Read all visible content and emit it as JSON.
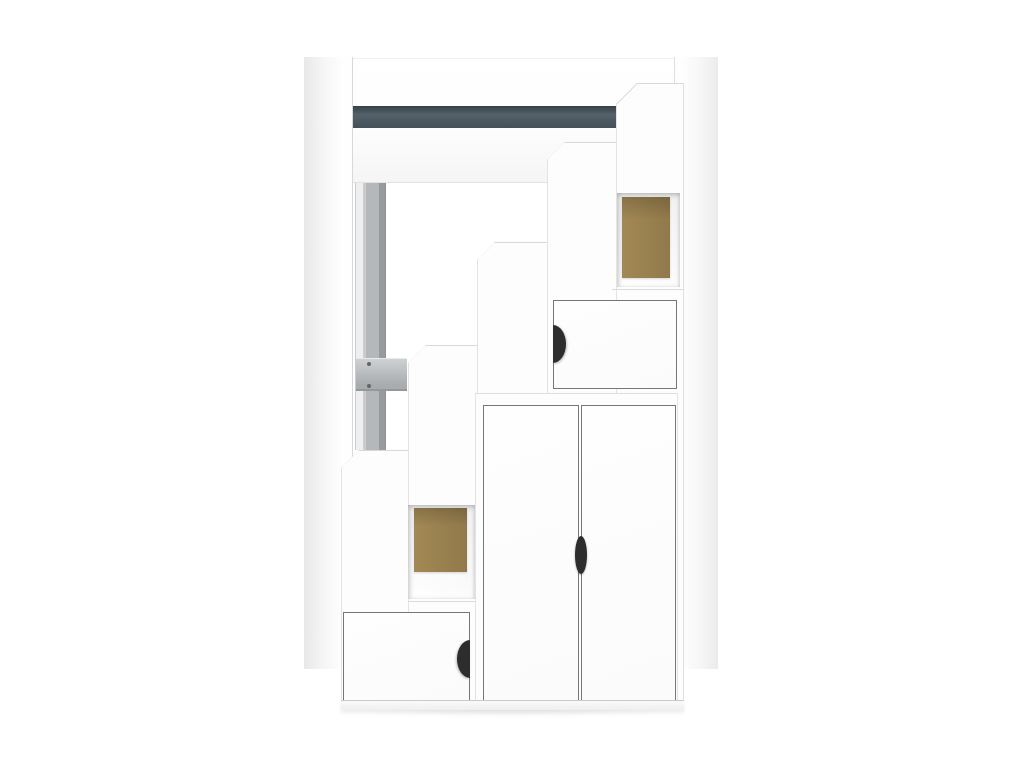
{
  "scene": {
    "description": "Studio product photograph of a white loft bed frame with an integrated staircase storage unit: five ascending step columns, two open cubbies with natural MDF back panels, two small hinged doors with black half-moon pulls, a tall double-door cabinet with a black lens pull, a dark slate accent rail across the bed frame and a grey metal support pole with a mounting bracket.",
    "background": "plain white studio sweep"
  },
  "colors": {
    "background": "#ffffff",
    "furniture_white": "#fdfdfd",
    "accent_stripe": "#48565f",
    "cubby_back_wood": "#a98e58",
    "metal_pole": "#b5b8ba",
    "metal_bracket": "#bcc0c2",
    "screw_grey": "#63676a",
    "handle_black": "#2d2d2d",
    "seam_grey": "#dcdcdc",
    "door_outline_grey": "#767676"
  },
  "objects": {
    "bed_frame": {
      "left_post": "white vertical post",
      "right_post": "white vertical post",
      "top_rail": "white horizontal bed rail",
      "accent_stripe": "dark slate horizontal stripe on rail",
      "support_pole": "grey metal pole",
      "bracket": "grey mounting bracket",
      "screw_count": 2
    },
    "staircase_unit": {
      "step_column_count": 5,
      "open_cubby_count": 2,
      "small_door_count": 2,
      "cabinet_door_count": 2,
      "handle_style": "black half-moon and lens pulls"
    }
  }
}
